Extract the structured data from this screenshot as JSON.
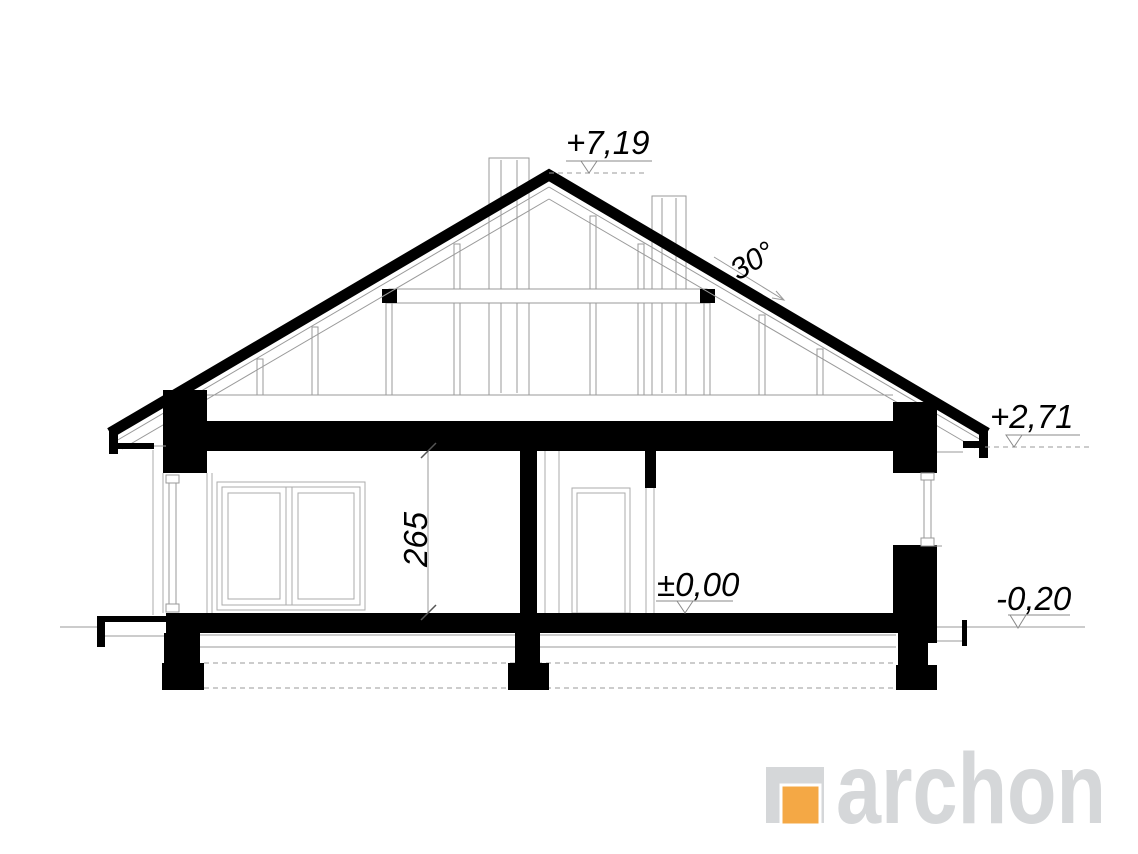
{
  "drawing_title": "house-cross-section",
  "levels": {
    "ridge": "+7,19",
    "eaves": "+2,71",
    "floor": "±0,00",
    "ground": "-0,20"
  },
  "dimensions": {
    "roof_angle": "30°",
    "interior_height": "265"
  },
  "logo": {
    "brand": "archon",
    "orange": "#f4a845",
    "gray": "#d5d7d9"
  },
  "colors": {
    "ink": "#000000",
    "line": "#9a9a9a",
    "background": "#ffffff"
  }
}
